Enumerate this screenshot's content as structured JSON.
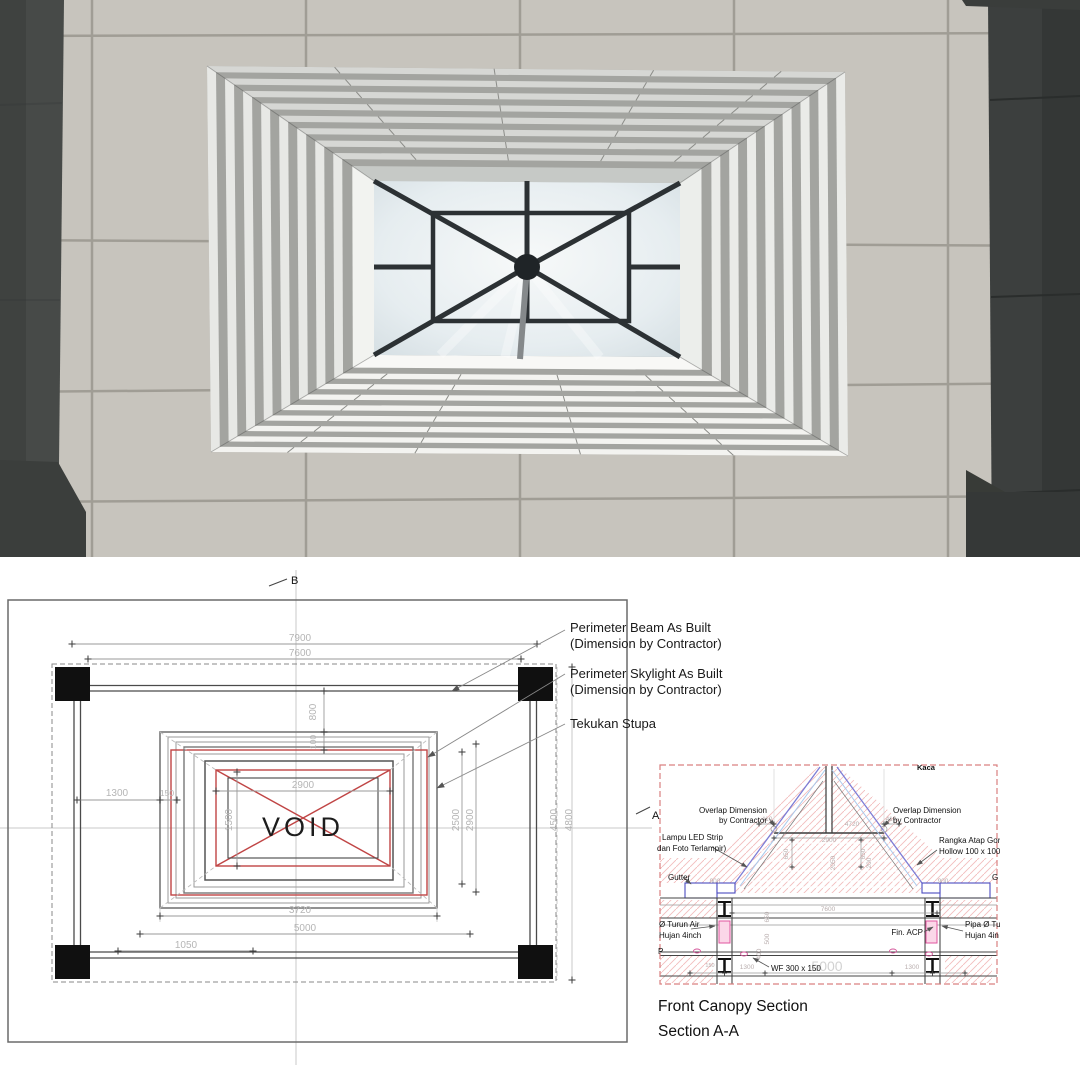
{
  "photo": {
    "colors": {
      "tile": "#c7c4bd",
      "grout": "#a09d95",
      "column_left": "#474a48",
      "column_right": "#3c3f3e",
      "louver_light": "#f3f3f0",
      "louver_shadow": "#a3a4a0",
      "sky": "#f7f9f9",
      "steel": "#2c3134"
    }
  },
  "plan": {
    "marker_top": "B",
    "marker_right": "A",
    "void_label": "VOID",
    "callouts": [
      {
        "line1": "Perimeter Beam As Built",
        "line2": "(Dimension by Contractor)"
      },
      {
        "line1": "Perimeter Skylight As Built",
        "line2": "(Dimension by Contractor)"
      },
      {
        "line1": "Tekukan Stupa",
        "line2": ""
      }
    ],
    "dim_labels": [
      {
        "t": "7900",
        "x": 300,
        "y": 81
      },
      {
        "t": "7600",
        "x": 300,
        "y": 96
      },
      {
        "t": "800",
        "x": 316,
        "y": 152,
        "rot": -90
      },
      {
        "t": "100",
        "x": 316,
        "y": 182,
        "rot": -90,
        "size": 8.5
      },
      {
        "t": "1300",
        "x": 117,
        "y": 236
      },
      {
        "t": "150",
        "x": 167,
        "y": 236,
        "size": 8.5
      },
      {
        "t": "2900",
        "x": 303,
        "y": 228
      },
      {
        "t": "1500",
        "x": 232,
        "y": 260,
        "rot": -90
      },
      {
        "t": "2500",
        "x": 459,
        "y": 260,
        "rot": -90
      },
      {
        "t": "2900",
        "x": 473,
        "y": 260,
        "rot": -90
      },
      {
        "t": "4500",
        "x": 557,
        "y": 260,
        "rot": -90
      },
      {
        "t": "4800",
        "x": 572,
        "y": 260,
        "rot": -90
      },
      {
        "t": "3720",
        "x": 300,
        "y": 353
      },
      {
        "t": "5000",
        "x": 305,
        "y": 371
      },
      {
        "t": "1050",
        "x": 186,
        "y": 388
      }
    ]
  },
  "section": {
    "title_line1": "Front Canopy Section",
    "title_line2": "Section A-A",
    "notes": [
      {
        "t": "Kaca",
        "x": 262,
        "y": 15,
        "bold": true,
        "size": 7.5
      },
      {
        "t": "Overlap Dimension",
        "x": 112,
        "y": 58,
        "anchor": "end"
      },
      {
        "t": "by Contractor",
        "x": 112,
        "y": 68,
        "anchor": "end"
      },
      {
        "t": "Overlap Dimension",
        "x": 238,
        "y": 58
      },
      {
        "t": "by Contractor",
        "x": 238,
        "y": 68
      },
      {
        "t": "Lampu LED Strip",
        "x": 7,
        "y": 85
      },
      {
        "t": "dan Foto Terlampir)",
        "x": 2,
        "y": 96
      },
      {
        "t": "Rangka Atap Gording",
        "x": 284,
        "y": 88
      },
      {
        "t": "Hollow 100 x 100 x 3",
        "x": 284,
        "y": 99
      },
      {
        "t": "Gutter",
        "x": 13,
        "y": 125
      },
      {
        "t": "G",
        "x": 337,
        "y": 125
      },
      {
        "t": "Ø Turun Air",
        "x": 4,
        "y": 172
      },
      {
        "t": "Hujan 4inch",
        "x": 4,
        "y": 183
      },
      {
        "t": "P",
        "x": 3,
        "y": 199
      },
      {
        "t": "Fin. ACP",
        "x": 268,
        "y": 180,
        "anchor": "end"
      },
      {
        "t": "Pipa Ø Tu",
        "x": 310,
        "y": 172
      },
      {
        "t": "Hujan 4in",
        "x": 310,
        "y": 183
      },
      {
        "t": "WF 300 x 150",
        "x": 116,
        "y": 216
      }
    ],
    "dim_labels": [
      {
        "t": "410",
        "x": 112,
        "y": 66
      },
      {
        "t": "4720",
        "x": 197,
        "y": 71
      },
      {
        "t": "410",
        "x": 236,
        "y": 66
      },
      {
        "t": "2900",
        "x": 174,
        "y": 87
      },
      {
        "t": "650",
        "x": 133,
        "y": 99,
        "rot": -90
      },
      {
        "t": "650",
        "x": 210,
        "y": 99,
        "rot": -90
      },
      {
        "t": "2050",
        "x": 180,
        "y": 108,
        "rot": -90
      },
      {
        "t": "200",
        "x": 216,
        "y": 108,
        "rot": -90
      },
      {
        "t": "900",
        "x": 60,
        "y": 128
      },
      {
        "t": "900",
        "x": 288,
        "y": 128
      },
      {
        "t": "7600",
        "x": 173,
        "y": 156
      },
      {
        "t": "650",
        "x": 114,
        "y": 162,
        "rot": -90
      },
      {
        "t": "500",
        "x": 114,
        "y": 184,
        "rot": -90
      },
      {
        "t": "400",
        "x": 106,
        "y": 199,
        "rot": -90
      },
      {
        "t": "150",
        "x": 55,
        "y": 212,
        "size": 5.5
      },
      {
        "t": "1300",
        "x": 92,
        "y": 214
      },
      {
        "t": "5000",
        "x": 172,
        "y": 216,
        "size": 14,
        "fill": "#d2d2d2"
      },
      {
        "t": "1300",
        "x": 257,
        "y": 214
      }
    ]
  }
}
